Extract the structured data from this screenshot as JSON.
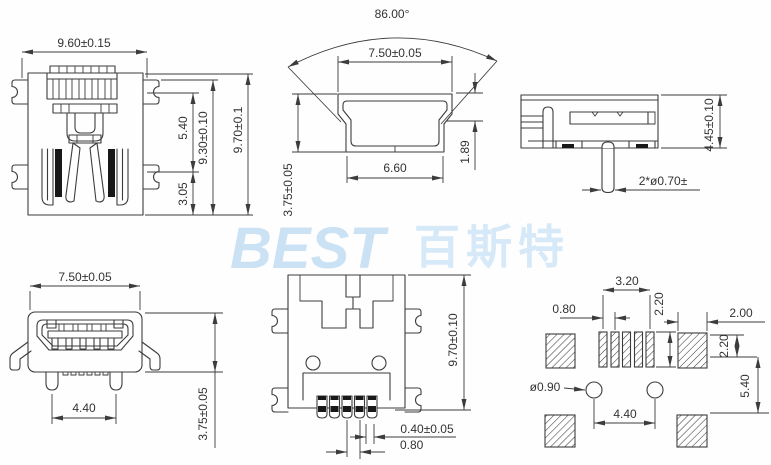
{
  "watermark": {
    "latin": "BEST",
    "cjk": "百斯特"
  },
  "colors": {
    "line": "#3c3c3c",
    "watermark_latin": "#cbe2f5",
    "watermark_cjk": "#d6e9f8"
  },
  "views": {
    "rear": {
      "width": "9.60±0.15",
      "upper_height": "5.40",
      "shell_height": "9.30±0.10",
      "total_height": "9.70±0.1",
      "lower_height": "3.05"
    },
    "plug_profile": {
      "angle": "86.00°",
      "top_width": "7.50±0.05",
      "bottom_width": "6.60",
      "lip_height": "1.89",
      "height": "3.75±0.05"
    },
    "side": {
      "height": "4.45±0.10",
      "pin_note": "2*ø0.70±"
    },
    "front": {
      "width": "7.50±0.05",
      "leg_span": "4.40",
      "height": "3.75±0.05"
    },
    "top": {
      "length": "9.70±0.10",
      "pin_width": "0.40±0.05",
      "pin_pitch": "0.80"
    },
    "pcb": {
      "pad_span": "3.20",
      "pad_pitch": "0.80",
      "pad_length": "2.20",
      "side_pad_width": "2.00",
      "side_pad_offset": "2.20",
      "row_gap": "5.40",
      "hole_dia": "ø0.90",
      "hole_span": "4.40"
    }
  }
}
